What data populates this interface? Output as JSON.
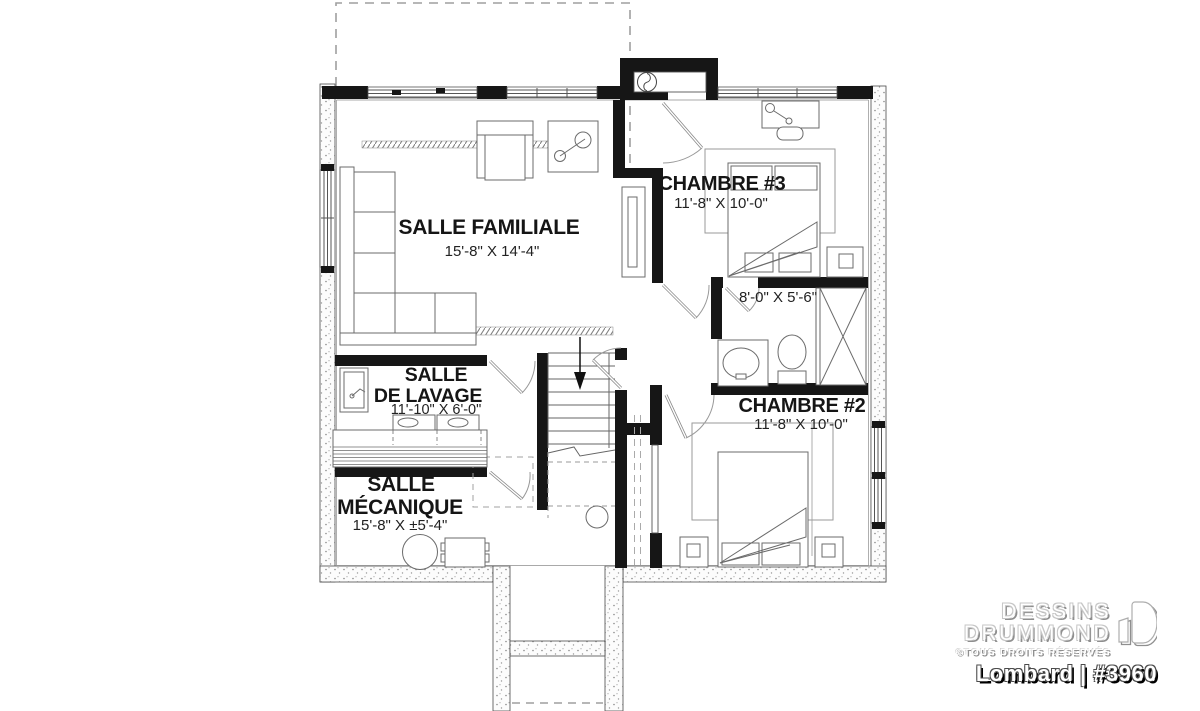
{
  "plan_labels": {
    "rooms": [
      {
        "lines": [
          "SALLE FAMILIALE"
        ],
        "dims": "15'-8\" X 14'-4\""
      },
      {
        "lines": [
          "CHAMBRE #3"
        ],
        "dims": "11'-8\" X 10'-0\""
      },
      {
        "lines": [
          "CHAMBRE #2"
        ],
        "dims": "11'-8\" X 10'-0\""
      },
      {
        "lines": [
          "SALLE",
          "DE LAVAGE"
        ],
        "dims": "11'-10\" X 6'-0\""
      },
      {
        "lines": [
          "SALLE",
          "MÉCANIQUE"
        ],
        "dims": "15'-8\" X ±5'-4\""
      },
      {
        "lines": [],
        "dims": "8'-0\" X 5'-6\""
      }
    ]
  },
  "branding": {
    "name_line1": "DESSINS",
    "name_line2": "DRUMMOND",
    "rights": "©TOUS DROITS RÉSERVÉS",
    "plan_id": "Lombard | #3960"
  },
  "colors": {
    "wall_black": "#161616",
    "line_gray": "#666666",
    "background": "#ffffff",
    "logo_shadow": "#8f8f8f"
  }
}
